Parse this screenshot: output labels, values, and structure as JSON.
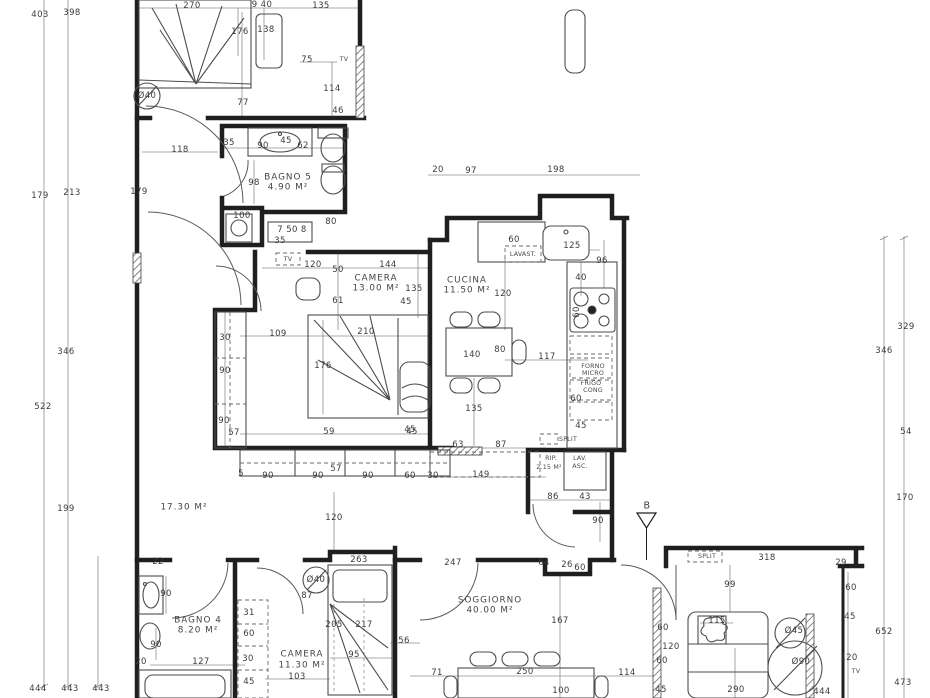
{
  "drawing": {
    "kind": "apartment floor plan",
    "section_marker": "B",
    "colors": {
      "walls": "#1f1f1f",
      "dimension_lines": "#909090",
      "text": "#3b3b3b",
      "background": "#ffffff"
    }
  },
  "rooms": [
    {
      "name": "BAGNO 5",
      "area": "4.90 M²"
    },
    {
      "name": "CAMERA",
      "area": "13.00 M²"
    },
    {
      "name": "CUCINA",
      "area": "11.50 M²"
    },
    {
      "name": "",
      "area": "17.30 M²"
    },
    {
      "name": "RIP.",
      "area": "2.15 M²"
    },
    {
      "name": "SOGGIORNO",
      "area": "40.00 M²"
    },
    {
      "name": "BAGNO 4",
      "area": "8.20 M²"
    },
    {
      "name": "CAMERA",
      "area": "11.30 M²"
    }
  ],
  "fixtures": [
    "LAVAST.",
    "FORNO MICRO",
    "FRIGO CONG",
    "LAV. ASC.",
    "SPLIT",
    "TV"
  ],
  "labels": [
    {
      "t": "403",
      "x": 40,
      "y": 15
    },
    {
      "t": "398",
      "x": 72,
      "y": 13
    },
    {
      "t": "179",
      "x": 40,
      "y": 196
    },
    {
      "t": "213",
      "x": 72,
      "y": 193
    },
    {
      "t": "346",
      "x": 66,
      "y": 352
    },
    {
      "t": "522",
      "x": 43,
      "y": 407
    },
    {
      "t": "199",
      "x": 66,
      "y": 509
    },
    {
      "t": "444",
      "x": 38,
      "y": 689
    },
    {
      "t": "443",
      "x": 70,
      "y": 689
    },
    {
      "t": "443",
      "x": 101,
      "y": 689
    },
    {
      "t": "270",
      "x": 192,
      "y": 6
    },
    {
      "t": "9 40",
      "x": 262,
      "y": 5
    },
    {
      "t": "135",
      "x": 321,
      "y": 6
    },
    {
      "t": "176",
      "x": 240,
      "y": 32
    },
    {
      "t": "138",
      "x": 266,
      "y": 30
    },
    {
      "t": "75",
      "x": 307,
      "y": 60
    },
    {
      "t": "114",
      "x": 332,
      "y": 89
    },
    {
      "t": "46",
      "x": 338,
      "y": 111
    },
    {
      "t": "77",
      "x": 243,
      "y": 103
    },
    {
      "t": "Ø40",
      "x": 147,
      "y": 96
    },
    {
      "t": "TV",
      "x": 344,
      "y": 60,
      "c": "tiny"
    },
    {
      "t": "118",
      "x": 180,
      "y": 150
    },
    {
      "t": "35",
      "x": 229,
      "y": 143
    },
    {
      "t": "90",
      "x": 263,
      "y": 146
    },
    {
      "t": "45",
      "x": 286,
      "y": 141
    },
    {
      "t": "62",
      "x": 303,
      "y": 146
    },
    {
      "t": "BAGNO 5",
      "x": 288,
      "y": 178,
      "c": "room"
    },
    {
      "t": "4.90 M²",
      "x": 288,
      "y": 188,
      "c": "room"
    },
    {
      "t": "98",
      "x": 254,
      "y": 183
    },
    {
      "t": "179",
      "x": 139,
      "y": 192
    },
    {
      "t": "100",
      "x": 242,
      "y": 216
    },
    {
      "t": "7 50 8",
      "x": 292,
      "y": 230
    },
    {
      "t": "35",
      "x": 280,
      "y": 241
    },
    {
      "t": "80",
      "x": 331,
      "y": 222
    },
    {
      "t": "TV",
      "x": 288,
      "y": 260,
      "c": "tiny"
    },
    {
      "t": "120",
      "x": 313,
      "y": 265
    },
    {
      "t": "50",
      "x": 338,
      "y": 270
    },
    {
      "t": "144",
      "x": 388,
      "y": 265
    },
    {
      "t": "CAMERA",
      "x": 376,
      "y": 279,
      "c": "room"
    },
    {
      "t": "13.00 M²",
      "x": 376,
      "y": 289,
      "c": "room"
    },
    {
      "t": "135",
      "x": 414,
      "y": 289
    },
    {
      "t": "45",
      "x": 406,
      "y": 302
    },
    {
      "t": "61",
      "x": 338,
      "y": 301
    },
    {
      "t": "109",
      "x": 278,
      "y": 334
    },
    {
      "t": "30",
      "x": 225,
      "y": 338
    },
    {
      "t": "210",
      "x": 366,
      "y": 332
    },
    {
      "t": "176",
      "x": 323,
      "y": 366
    },
    {
      "t": "90",
      "x": 225,
      "y": 371
    },
    {
      "t": "90",
      "x": 224,
      "y": 421
    },
    {
      "t": "57",
      "x": 234,
      "y": 433
    },
    {
      "t": "59",
      "x": 329,
      "y": 432
    },
    {
      "t": "45",
      "x": 412,
      "y": 432
    },
    {
      "t": "5",
      "x": 241,
      "y": 474
    },
    {
      "t": "90",
      "x": 268,
      "y": 476
    },
    {
      "t": "90",
      "x": 318,
      "y": 476
    },
    {
      "t": "57",
      "x": 336,
      "y": 469
    },
    {
      "t": "90",
      "x": 368,
      "y": 476
    },
    {
      "t": "60",
      "x": 410,
      "y": 476
    },
    {
      "t": "30",
      "x": 433,
      "y": 476
    },
    {
      "t": "17.30 M²",
      "x": 184,
      "y": 508,
      "c": "room"
    },
    {
      "t": "120",
      "x": 334,
      "y": 518
    },
    {
      "t": "20",
      "x": 438,
      "y": 170
    },
    {
      "t": "97",
      "x": 471,
      "y": 171
    },
    {
      "t": "198",
      "x": 556,
      "y": 170
    },
    {
      "t": "60",
      "x": 514,
      "y": 240
    },
    {
      "t": "125",
      "x": 572,
      "y": 246
    },
    {
      "t": "LAVAST.",
      "x": 523,
      "y": 255,
      "c": "tiny"
    },
    {
      "t": "96",
      "x": 602,
      "y": 261
    },
    {
      "t": "40",
      "x": 581,
      "y": 278
    },
    {
      "t": "CUCINA",
      "x": 467,
      "y": 281,
      "c": "room"
    },
    {
      "t": "11.50 M²",
      "x": 467,
      "y": 291,
      "c": "room"
    },
    {
      "t": "120",
      "x": 503,
      "y": 294
    },
    {
      "t": "140",
      "x": 472,
      "y": 355
    },
    {
      "t": "80",
      "x": 500,
      "y": 350
    },
    {
      "t": "117",
      "x": 547,
      "y": 357
    },
    {
      "t": "60",
      "x": 577,
      "y": 312,
      "r": -90
    },
    {
      "t": "FORNO",
      "x": 593,
      "y": 367,
      "c": "tiny"
    },
    {
      "t": "MICRO",
      "x": 593,
      "y": 374,
      "c": "tiny"
    },
    {
      "t": "FRIGO",
      "x": 591,
      "y": 384,
      "c": "tiny"
    },
    {
      "t": "CONG",
      "x": 593,
      "y": 391,
      "c": "tiny"
    },
    {
      "t": "60",
      "x": 576,
      "y": 399
    },
    {
      "t": "135",
      "x": 474,
      "y": 409
    },
    {
      "t": "45",
      "x": 410,
      "y": 430
    },
    {
      "t": "45",
      "x": 581,
      "y": 426
    },
    {
      "t": "SPLIT",
      "x": 568,
      "y": 440,
      "c": "tiny"
    },
    {
      "t": "63",
      "x": 458,
      "y": 445
    },
    {
      "t": "87",
      "x": 501,
      "y": 445
    },
    {
      "t": "149",
      "x": 481,
      "y": 475
    },
    {
      "t": "RIP.",
      "x": 551,
      "y": 459,
      "c": "tiny"
    },
    {
      "t": "2.15 M²",
      "x": 549,
      "y": 468,
      "c": "tiny"
    },
    {
      "t": "LAV.",
      "x": 580,
      "y": 459,
      "c": "tiny"
    },
    {
      "t": "ASC.",
      "x": 580,
      "y": 467,
      "c": "tiny"
    },
    {
      "t": "86",
      "x": 553,
      "y": 497
    },
    {
      "t": "43",
      "x": 585,
      "y": 497
    },
    {
      "t": "90",
      "x": 598,
      "y": 521
    },
    {
      "t": "B",
      "x": 647,
      "y": 506,
      "c": "big"
    },
    {
      "t": "263",
      "x": 359,
      "y": 560
    },
    {
      "t": "22",
      "x": 158,
      "y": 562
    },
    {
      "t": "247",
      "x": 453,
      "y": 563
    },
    {
      "t": "64",
      "x": 544,
      "y": 563
    },
    {
      "t": "26",
      "x": 567,
      "y": 565
    },
    {
      "t": "60",
      "x": 580,
      "y": 568
    },
    {
      "t": "SOGGIORNO",
      "x": 490,
      "y": 601,
      "c": "room"
    },
    {
      "t": "40.00 M²",
      "x": 490,
      "y": 611,
      "c": "room"
    },
    {
      "t": "167",
      "x": 560,
      "y": 621
    },
    {
      "t": "56",
      "x": 404,
      "y": 641
    },
    {
      "t": "71",
      "x": 437,
      "y": 673
    },
    {
      "t": "250",
      "x": 525,
      "y": 672
    },
    {
      "t": "114",
      "x": 627,
      "y": 673
    },
    {
      "t": "100",
      "x": 561,
      "y": 691
    },
    {
      "t": "60",
      "x": 663,
      "y": 628
    },
    {
      "t": "120",
      "x": 671,
      "y": 647
    },
    {
      "t": "60",
      "x": 662,
      "y": 661
    },
    {
      "t": "45",
      "x": 661,
      "y": 690
    },
    {
      "t": "444",
      "x": 822,
      "y": 692
    },
    {
      "t": "SPLIT",
      "x": 707,
      "y": 557,
      "c": "tiny"
    },
    {
      "t": "318",
      "x": 767,
      "y": 558
    },
    {
      "t": "29",
      "x": 841,
      "y": 563
    },
    {
      "t": "99",
      "x": 730,
      "y": 585
    },
    {
      "t": "60",
      "x": 851,
      "y": 588
    },
    {
      "t": "45",
      "x": 850,
      "y": 617
    },
    {
      "t": "652",
      "x": 884,
      "y": 632
    },
    {
      "t": "120",
      "x": 849,
      "y": 658
    },
    {
      "t": "TV",
      "x": 856,
      "y": 672,
      "c": "tiny"
    },
    {
      "t": "473",
      "x": 903,
      "y": 683
    },
    {
      "t": "Ø45",
      "x": 794,
      "y": 631
    },
    {
      "t": "Ø90",
      "x": 801,
      "y": 662
    },
    {
      "t": "115",
      "x": 717,
      "y": 621
    },
    {
      "t": "290",
      "x": 736,
      "y": 690
    },
    {
      "t": "329",
      "x": 906,
      "y": 327
    },
    {
      "t": "346",
      "x": 884,
      "y": 351
    },
    {
      "t": "54",
      "x": 906,
      "y": 432
    },
    {
      "t": "170",
      "x": 905,
      "y": 498
    },
    {
      "t": "90",
      "x": 166,
      "y": 594
    },
    {
      "t": "BAGNO 4",
      "x": 198,
      "y": 621,
      "c": "room"
    },
    {
      "t": "8.20 M²",
      "x": 198,
      "y": 631,
      "c": "room"
    },
    {
      "t": "90",
      "x": 156,
      "y": 645
    },
    {
      "t": "20",
      "x": 141,
      "y": 662
    },
    {
      "t": "127",
      "x": 201,
      "y": 662
    },
    {
      "t": "87",
      "x": 307,
      "y": 596
    },
    {
      "t": "31",
      "x": 249,
      "y": 613
    },
    {
      "t": "60",
      "x": 249,
      "y": 634
    },
    {
      "t": "30",
      "x": 248,
      "y": 659
    },
    {
      "t": "45",
      "x": 249,
      "y": 682
    },
    {
      "t": "Ø40",
      "x": 316,
      "y": 580
    },
    {
      "t": "CAMERA",
      "x": 302,
      "y": 655,
      "c": "room"
    },
    {
      "t": "11.30 M²",
      "x": 302,
      "y": 666,
      "c": "room"
    },
    {
      "t": "103",
      "x": 297,
      "y": 677
    },
    {
      "t": "95",
      "x": 354,
      "y": 655
    },
    {
      "t": "205",
      "x": 334,
      "y": 625
    },
    {
      "t": "217",
      "x": 364,
      "y": 625
    }
  ]
}
